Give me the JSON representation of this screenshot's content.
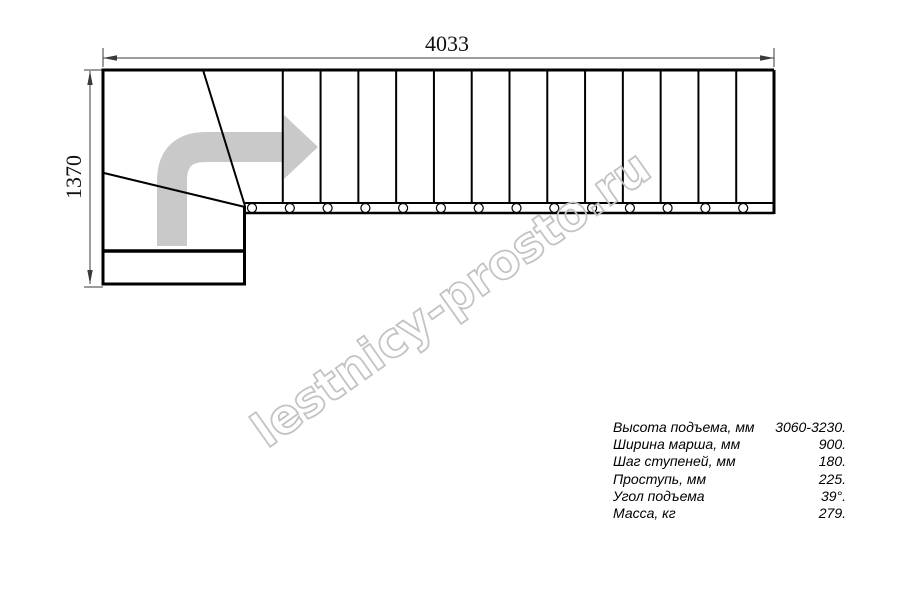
{
  "drawing": {
    "title": "staircase-plan-view",
    "width_dimension": "4033",
    "height_dimension": "1370",
    "tread_segments": 14,
    "baluster_count": 14,
    "line_color": "#000000",
    "dim_line_color": "#3a3a3a",
    "direction_arrow_color": "#c9c9c9"
  },
  "watermark": {
    "text": "lestnicy-prosto.ru",
    "stroke_color": "#c3c3c3"
  },
  "specs": {
    "rows": [
      {
        "label": "Высота подъема, мм",
        "value": "3060-3230."
      },
      {
        "label": "Ширина марша, мм",
        "value": "900."
      },
      {
        "label": "Шаг ступеней, мм",
        "value": "180."
      },
      {
        "label": "Проступь, мм",
        "value": "225."
      },
      {
        "label": "Угол подъема",
        "value": "39°."
      },
      {
        "label": "Масса, кг",
        "value": "279."
      }
    ]
  }
}
